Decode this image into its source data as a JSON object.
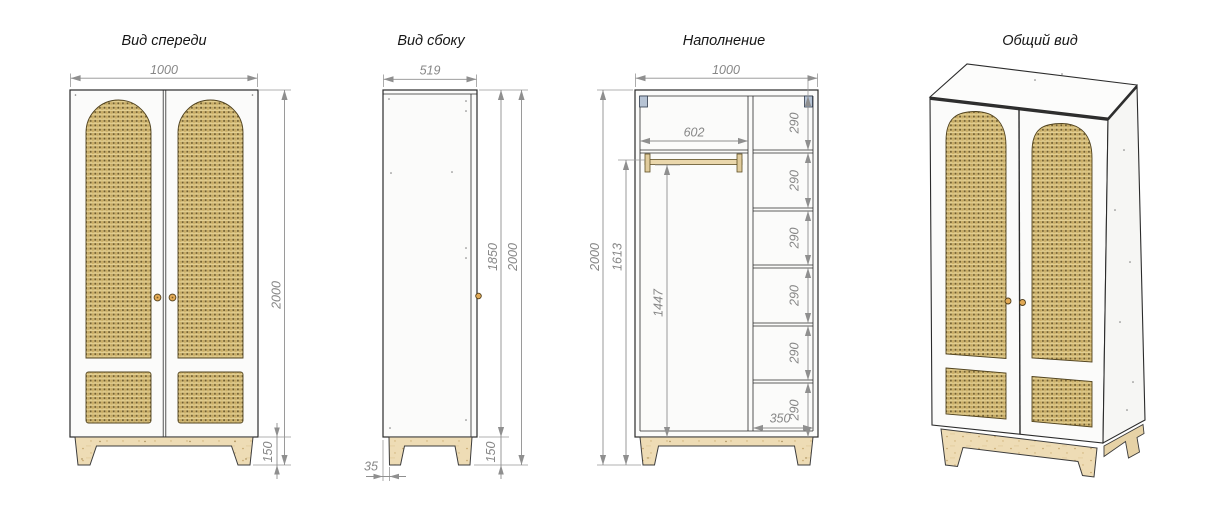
{
  "canvas": {
    "width": 1218,
    "height": 529,
    "background": "#ffffff"
  },
  "views": {
    "front": {
      "title": "Вид спереди",
      "dim_width": "1000",
      "dim_height": "2000",
      "dim_base_height": "150"
    },
    "side": {
      "title": "Вид сбоку",
      "dim_depth": "519",
      "dim_body_height": "1850",
      "dim_height": "2000",
      "dim_base_height": "150",
      "dim_leg_offset": "35"
    },
    "interior": {
      "title": "Наполнение",
      "dim_width": "1000",
      "dim_rod_opening": "602",
      "dim_height": "2000",
      "dim_rod_height": "1613",
      "dim_hanging_height": "1447",
      "dim_shelf_width": "350",
      "dim_shelf_gaps": [
        "290",
        "290",
        "290",
        "290",
        "290",
        "290"
      ]
    },
    "overall": {
      "title": "Общий вид"
    }
  },
  "colors": {
    "outline": "#2b2b2b",
    "dimension": "#8f8f8f",
    "rattan_base": "#dcc584",
    "rattan_stripe": "#cdb26c",
    "rattan_dot": "#6e5b2d",
    "plywood": "#eedcb5",
    "knob": "#e2aa56",
    "bracket": "#b6c3d4",
    "rod": "#ead7ac"
  }
}
